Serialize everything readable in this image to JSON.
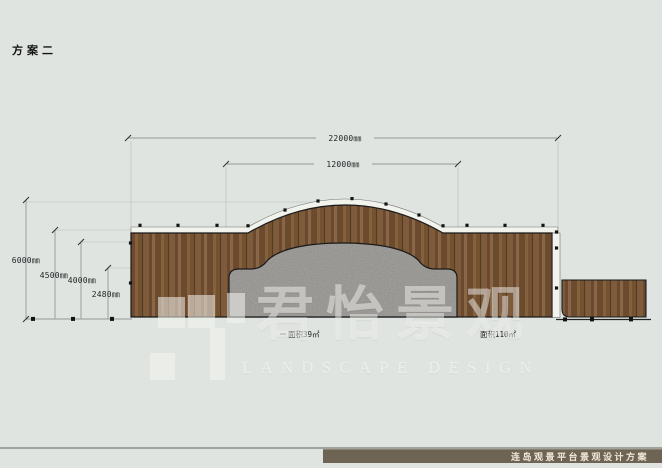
{
  "scheme_label": "方案二",
  "plan": {
    "dim_top_width": "22000㎜",
    "dim_arch_width": "12000㎜",
    "dim_height_total": "6000㎜",
    "dim_height_deck": "4500㎜",
    "dim_height_arch": "4000㎜",
    "dim_height_base": "2480㎜",
    "area_stone": "面积39㎡",
    "area_deck": "面积110㎡",
    "colors": {
      "background": "#e0e4e1",
      "wood": "#7a5737",
      "stone": "#92908b",
      "outline": "#1a1a1a",
      "fascia": "#f3f3ee"
    }
  },
  "watermark": {
    "brand": "君怡景观",
    "subtitle": "LANDSCAPE DESIGN"
  },
  "footer": {
    "project_title": "连岛观景平台景观设计方案",
    "bar_color": "#6e6454"
  }
}
